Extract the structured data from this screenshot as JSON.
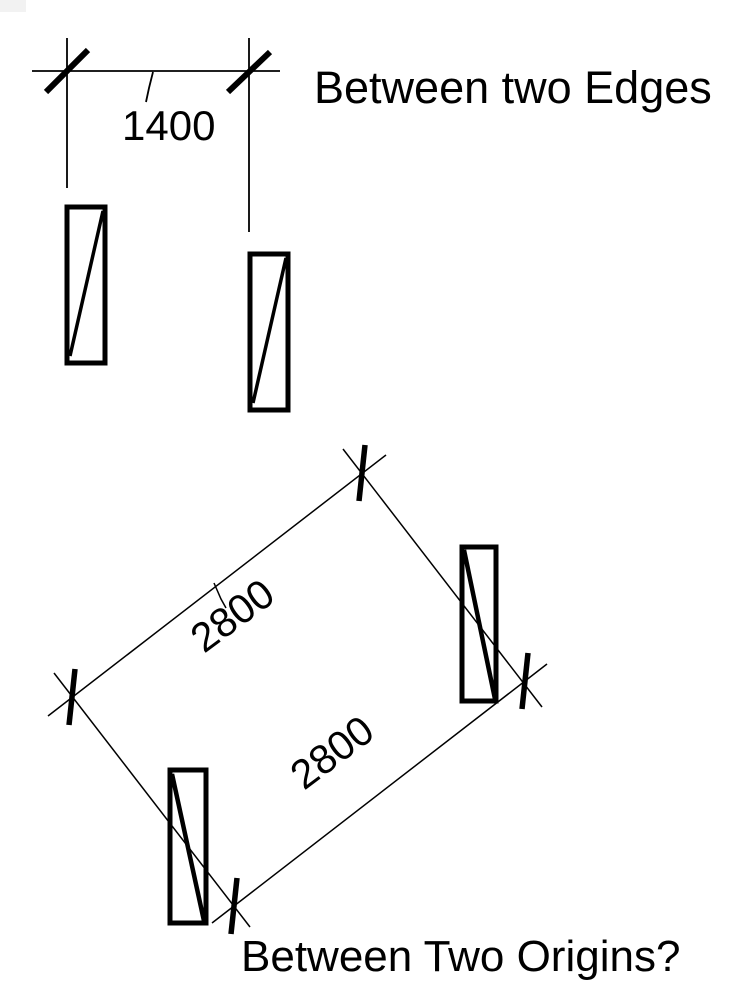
{
  "page": {
    "background": "#ffffff",
    "ink": "#000000"
  },
  "top_figure": {
    "caption": "Between two Edges",
    "dimension": {
      "value": "1400"
    }
  },
  "bottom_figure": {
    "caption": "Between Two Origins?",
    "dimension_upper": {
      "value": "2800"
    },
    "dimension_lower": {
      "value": "2800"
    }
  }
}
